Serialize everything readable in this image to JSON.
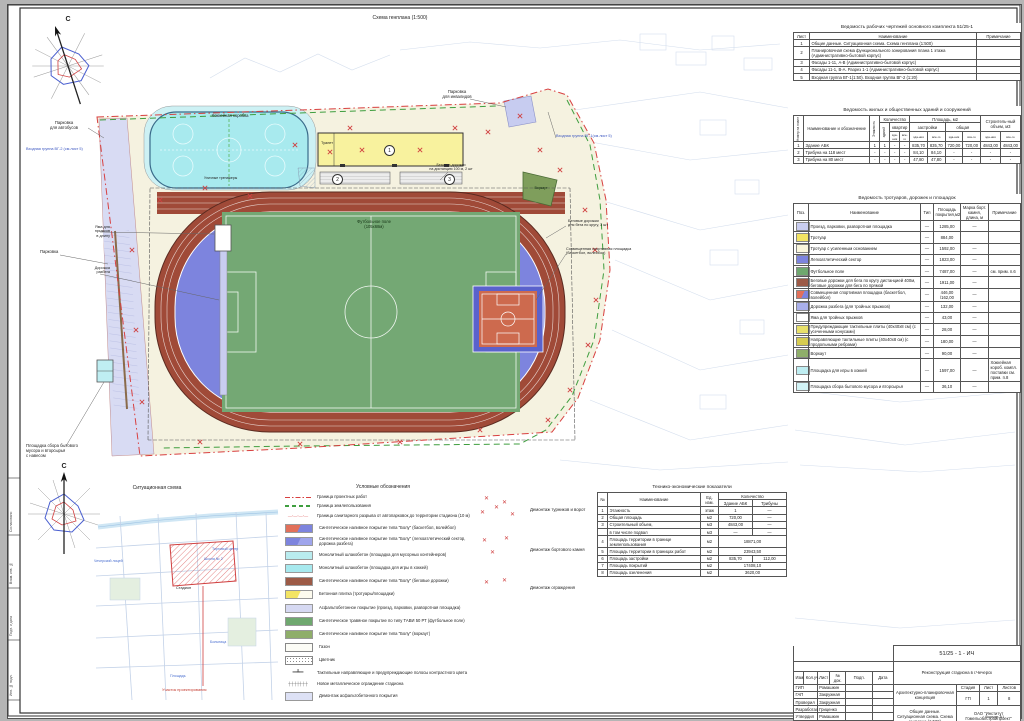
{
  "sheet": {
    "plan_title": "Схема генплана (1:500)",
    "north": "С",
    "format": "Формат А1"
  },
  "plan_labels": {
    "bus_parking": "Парковка\nдля автобусов",
    "entrance2": "Входная группа ВГ-2 (см.лист 5)",
    "parking": "Парковка",
    "waste": "Площадка сбора бытового\nмусора и вторсырья\nс навесом",
    "hockey": "Хоккейная коробка",
    "gym": "Уличные тренажеры",
    "toilet": "Туалет",
    "disabled_parking": "Парковка\nдля инвалидов",
    "entrance1": "Входная группа ВГ-1(см.лист 5)",
    "sprint": "Беговые дорожки\nна дистанцию 100 м, 2 шт",
    "football": "Футбольное поле\n(105х68м)",
    "jump_pit": "Яма для\nпрыжков\nв длину",
    "runup": "Дорожка\nразбега",
    "track3": "Беговые дорожки\nдля бега по кругу, 3 шт",
    "court": "Совмещенная спортивная площадка\n(баскетбол, волейбол)",
    "workout": "Воркаут",
    "pos1": "1",
    "pos2": "2",
    "pos3": "3"
  },
  "worksheet_table": {
    "title": "Ведомость рабочих чертежей основного комплекта 51/25-1",
    "col_list": "Лист",
    "col_name": "Наименование",
    "col_note": "Примечание",
    "rows": [
      {
        "num": "1",
        "name": "Общие данные. Ситуационная схема. Схема генплана (1:500)",
        "note": ""
      },
      {
        "num": "2",
        "name": "Планировочная схема функционального зонирования плана 1 этажа (Административно-бытовой корпус)",
        "note": ""
      },
      {
        "num": "3",
        "name": "Фасады 1-11, А-В (Административно-бытовой корпус)",
        "note": ""
      },
      {
        "num": "4",
        "name": "Фасады 11-1, В-А. Разрез 1-1 (Административно-бытовой корпус)",
        "note": ""
      },
      {
        "num": "5",
        "name": "Входная группа ВГ-1(1:50). Входная группа ВГ-2 (1:20)",
        "note": ""
      }
    ]
  },
  "buildings_table": {
    "title": "Ведомость жилых и общественных зданий и сооружений",
    "h_num": "Номер на плане",
    "h_name": "Наименование и обозначение",
    "h_floors": "Этажность",
    "h_qty": "Количество",
    "h_bld": "зданий",
    "h_flats": "квартир",
    "h_area": "Площадь, м2",
    "h_footprint": "застройки",
    "h_total_area": "общая",
    "h_vol": "Строитель-ный объем, м3",
    "h_bldg": "зда-ния",
    "h_all": "все-го",
    "rows": [
      {
        "cells": [
          "1",
          "Здание АБК",
          "1",
          "1",
          "-",
          "-",
          "835,70",
          "835,70",
          "720,00",
          "720,00",
          "4843,00",
          "4843,00"
        ]
      },
      {
        "cells": [
          "2",
          "Трибуна на 118 мест",
          "-",
          "-",
          "-",
          "-",
          "84,10",
          "84,10",
          "-",
          "-",
          "-",
          "-"
        ]
      },
      {
        "cells": [
          "3",
          "Трибуна на 80 мест",
          "-",
          "-",
          "-",
          "-",
          "47,80",
          "47,80",
          "-",
          "-",
          "-",
          "-"
        ]
      }
    ]
  },
  "surfaces_table": {
    "title": "Ведомость тротуаров, дорожек и площадок",
    "h_pos": "Поз.",
    "h_name": "Наименование",
    "h_type": "Тип",
    "h_area": "Площадь покрытия,м2",
    "h_mark": "Марка борт. камня, длина, м",
    "h_note": "Примечание",
    "rows": [
      {
        "color": "#c9cdf0",
        "name": "Проезд, парковки, разворотная площадка",
        "type": "—",
        "area": "1285,00",
        "mark": "—",
        "note": ""
      },
      {
        "color": "#f3e463",
        "name": "Тротуар",
        "type": "—",
        "area": "884,00",
        "mark": "",
        "note": ""
      },
      {
        "color": "#faf6dc",
        "name": "Тротуар с усиленным основанием",
        "type": "—",
        "area": "1592,00",
        "mark": "—",
        "note": ""
      },
      {
        "color": "#7d84de",
        "name": "Легкоатлетический сектор",
        "type": "—",
        "area": "1823,00",
        "mark": "—",
        "note": ""
      },
      {
        "color": "#6fa86f",
        "name": "Футбольное поле",
        "type": "—",
        "area": "7487,00",
        "mark": "—",
        "note": "см. прим. п.6"
      },
      {
        "color": "#9c5a46",
        "name": "Беговые дорожки для бега по кругу дистанцией 400м, беговые дорожки для бега по прямой",
        "type": "—",
        "area": "1911,00",
        "mark": "—",
        "note": ""
      },
      {
        "color": "#e2705a",
        "color2": "#7d84de",
        "name": "Совмещенная спортивная площадка (баскетбол, волейбол)",
        "type": "—",
        "area": "446,00 /162,00",
        "mark": "—",
        "note": ""
      },
      {
        "color": "#aab0ea",
        "name": "Дорожка разбега (для тройных прыжков)",
        "type": "—",
        "area": "132,00",
        "mark": "—",
        "note": ""
      },
      {
        "color": "#ffffff",
        "name": "Яма для тройных прыжков",
        "type": "—",
        "area": "43,00",
        "mark": "—",
        "note": ""
      },
      {
        "color": "#e8e06a",
        "name": "Предупреждающие тактильные плиты (40х40х8 см) (с усеченными конусами)",
        "type": "—",
        "area": "28,00",
        "mark": "—",
        "note": ""
      },
      {
        "color": "#d6cc52",
        "name": "Направляющие тактильные плиты (40х40х8 см) (с продольными ребрами)",
        "type": "—",
        "area": "180,00",
        "mark": "—",
        "note": ""
      },
      {
        "color": "#8fae6a",
        "name": "Воркаут",
        "type": "—",
        "area": "90,00",
        "mark": "—",
        "note": ""
      },
      {
        "color": "#bfeef2",
        "name": "Площадка для игры в хоккей",
        "type": "—",
        "area": "1597,00",
        "mark": "—",
        "note": "Хоккейная короб. компл. поставки см. прим. п.8"
      },
      {
        "color": "#d2f3f6",
        "name": "Площадка сбора бытового мусора и вторсырья",
        "type": "—",
        "area": "36,10",
        "mark": "—",
        "note": ""
      }
    ]
  },
  "tech_table": {
    "title": "Технико-экономические показатели",
    "h_num": "№",
    "h_name": "Наименование",
    "h_unit": "Ед. изм.",
    "h_qty": "Количество",
    "h_abk": "Здание АБК",
    "h_trib": "Трибуны",
    "rows": [
      {
        "num": "1",
        "name": "Этажность",
        "unit": "этаж",
        "a": "1",
        "b": "—",
        "span": false
      },
      {
        "num": "2",
        "name": "Общая площадь",
        "unit": "м2",
        "a": "720,00",
        "b": "—",
        "span": false
      },
      {
        "num": "3",
        "name": "Строительный объем,",
        "unit": "м3",
        "a": "4843,00",
        "b": "—",
        "span": false
      },
      {
        "num": "",
        "name": "в том числе подвал",
        "unit": "м3",
        "a": "—",
        "b": "—",
        "span": false
      },
      {
        "num": "4",
        "name": "Площадь территории в границе землепользования",
        "unit": "м2",
        "a": "18871,00",
        "b": "",
        "span": true
      },
      {
        "num": "5",
        "name": "Площадь территории в границах работ",
        "unit": "м2",
        "a": "23943,50",
        "b": "",
        "span": true
      },
      {
        "num": "6",
        "name": "Площадь застройки",
        "unit": "м2",
        "a": "835,70",
        "b": "112,00",
        "span": false
      },
      {
        "num": "7",
        "name": "Площадь покрытий",
        "unit": "м2",
        "a": "17408,10",
        "b": "",
        "span": true
      },
      {
        "num": "8",
        "name": "Площадь озеленения",
        "unit": "м2",
        "a": "3620,00",
        "b": "",
        "span": true
      }
    ]
  },
  "legend": {
    "title": "Условные обозначения",
    "items": [
      {
        "kind": "dashdot",
        "color": "#d84040",
        "label": "Граница проектных работ"
      },
      {
        "kind": "dash",
        "color": "#3f9e3f",
        "label": "Граница землепользования"
      },
      {
        "kind": "circles",
        "color": "#d84040",
        "label": "Граница санитарного разрыва от автопарковок до территории стадиона (10 м)"
      },
      {
        "kind": "swatch",
        "color": "#e2705a",
        "color2": "#7d84de",
        "label": "Синтетическое наливное покрытие типа \"Болу\" (баскетбол, волейбол)"
      },
      {
        "kind": "swatch",
        "color": "#7d84de",
        "color2": "#9fa5ec",
        "label": "Синтетическое наливное покрытие типа \"Болу\" (легкоатлетический сектор, дорожка разбега)"
      },
      {
        "kind": "swatch",
        "color": "#b9ecef",
        "label": "Монолитный шлакобетон (площадка для мусорных контейнеров)"
      },
      {
        "kind": "swatch",
        "color": "#a7e9ee",
        "label": "Монолитный шлакобетон (площадка для игры в хоккей)"
      },
      {
        "kind": "swatch",
        "color": "#9c5a46",
        "label": "Синтетическое наливное покрытие типа \"Болу\" (беговые дорожки)"
      },
      {
        "kind": "swatch",
        "color": "#f3e463",
        "color2": "#fdfbee",
        "label": "Бетонная плитка (тротуары/площадки)"
      },
      {
        "kind": "swatch",
        "color": "#d6d9f2",
        "label": "Асфальтобетонное покрытие (проезд, парковки, разворотная площадка)"
      },
      {
        "kind": "swatch",
        "color": "#6fa86f",
        "label": "Синтетическое травяное покрытие по типу ТАВИ 50 РТ (футбольное поле)"
      },
      {
        "kind": "swatch",
        "color": "#8fae6a",
        "label": "Синтетическое наливное покрытие типа \"Болу\" (воркаут)"
      },
      {
        "kind": "swatch",
        "color": "#fcfcf6",
        "label": "Газон"
      },
      {
        "kind": "dots",
        "color": "#8a8a8a",
        "label": "Цветник"
      },
      {
        "kind": "tactile",
        "color": "#555555",
        "label": "Тактильные направляющие и предупреждающие полосы контрастного цвета"
      },
      {
        "kind": "fence",
        "color": "#555555",
        "label": "Новое металлическое ограждение стадиона"
      },
      {
        "kind": "swatch",
        "color": "#dde1f5",
        "label": "Демонтаж асфальтобетонного покрытия"
      }
    ]
  },
  "demolition": {
    "items": [
      {
        "label": "Демонтаж  турников и ворот"
      },
      {
        "label": "Демонтаж  бортового камня"
      },
      {
        "label": "Демонтаж ограждения"
      }
    ]
  },
  "notes": [
    {
      "text": "1. Архитектурно-планировочная концепция разработана в соответствии с действующими ТНПА и на основании договора."
    },
    {
      "text": "2. Генеральный план разработан на основании задания на проектирование и съемки масштаба 1:500, выполненной ОАО \"Институт Гомельоблстройпроект\". Система высот Балтийская, система координат местная."
    },
    {
      "text": "3. За относительную отметку 0.000 принят уровень чистого пола здания (поз.1 по генплану)."
    },
    {
      "text": "4. В местах пересечения пешеходных путей с проездами, указанных на генплане, предусмотрено устройство \"утопленного\" бортового камня БР 100.30.15 (СТБ 1097-2012) и бортового камня БР 100.30.18 СТБ 1097-2012 в соответствии с требованиями ТКП 45-3.02-6-2005 и СТБ 2030-2010."
    },
    {
      "text": "5. Предупреждающие тактильные плиты желтого цвета уложить полосой шириной эффективной дорожки не менее 800 мм перед началом пешеходных маршей, входами в здание поз.1, мест пересечения пешеходных путей с проездами, в соответствии с требованиями ТКП 45-3.02-6-2005 (изм.№2). Форма декоративных элементов - усеченные конусы. Вдоль тротуаров по основным пешеходным путям, а также по направлению к входам выполнить полосы из направляющих тактильных плит желтого цвета в соответствии с требованиями ТКП 45-3.02-6-2005 (изм.№2). Форма декоративных элементов - продольные ребра."
    },
    {
      "text": "6. При укладке верхнего слоя фракции 8-10мм добавлять слой щебня (фракция отсева 3-5мм) (количество отсева - 20% от общего объема фракции 8-10мм) для устройства плотного верхнего покрытия перед укладкой искусственного травяного покрытия и для лучшего прилегания к бортам лотков."
    },
    {
      "text": "7. Устройство трибун (поз.2,3) разработки УП \"Светотехника\" ОСТмол ТКЗ."
    },
    {
      "text": "8. Хоккейная коробка комплектной поставки по типу ОДО \"Альфа-Сталь\" Гомельская область, г.Добруш."
    }
  ],
  "situational": {
    "title": "Ситуационная схема",
    "site_label": "Участок проектирования",
    "stadium": "Стадион",
    "lyceum": "Чечерский лицей",
    "mall": "Торговый центр",
    "school": "Школа № 2",
    "hospital": "Больница",
    "square": "Площадь"
  },
  "margin_labels": [
    {
      "text": "Согласовано"
    },
    {
      "text": "Взам. инв. №"
    },
    {
      "text": "Подп. и дата"
    },
    {
      "text": "Инв. № подл."
    }
  ],
  "titleblock": {
    "doc_code": "51/25 - 1 - ИЧ",
    "project": "Реконструкция стадиона в г.Чечерск",
    "section": "Архитектурно-планировочная концепция",
    "content": "Общие данные. Ситуационная схема. Схема генплана (1:500)",
    "org": "ОАО \"Институт Гомельоблстройпроект\"",
    "stage_label": "Стадия",
    "sheet_label": "Лист",
    "sheets_label": "Листов",
    "stage": "ГП",
    "sheet": "1",
    "sheets": "8",
    "hdr": [
      "Изм.",
      "Кол.уч.",
      "Лист",
      "№ док.",
      "Подп.",
      "Дата"
    ],
    "roles": [
      {
        "role": "ГИП",
        "name": "Ромашкин"
      },
      {
        "role": "ГАП",
        "name": "Закружная"
      },
      {
        "role": "Проверил",
        "name": "Закружная"
      },
      {
        "role": "Разработал",
        "name": "Гриценко"
      },
      {
        "role": "Утвердил",
        "name": "Ромашкин"
      },
      {
        "role": "Н.контр.",
        "name": "Бердин"
      }
    ]
  }
}
